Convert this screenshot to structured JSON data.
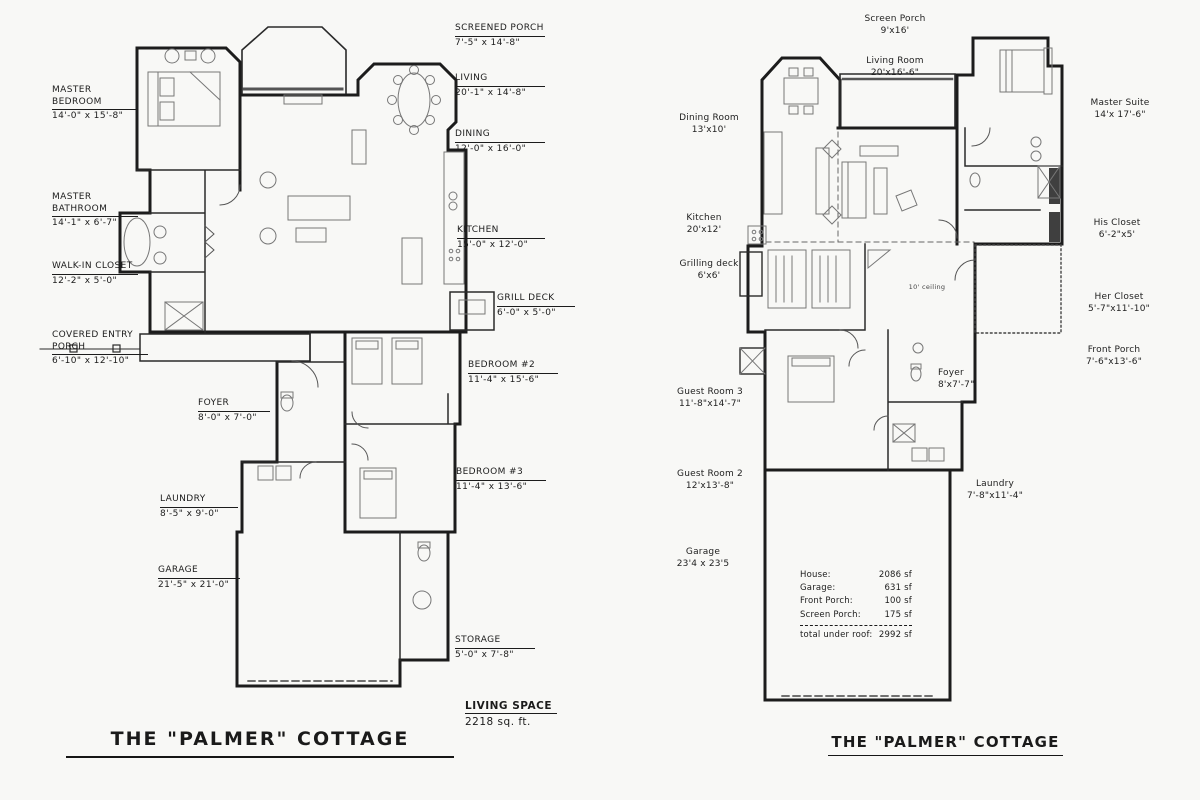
{
  "left_plan": {
    "title": "THE \"PALMER\" COTTAGE",
    "living_space": {
      "label": "LIVING SPACE",
      "value": "2218 sq. ft."
    },
    "labels": [
      {
        "name": "MASTER BEDROOM",
        "dims": "14'-0\" x 15'-8\""
      },
      {
        "name": "MASTER BATHROOM",
        "dims": "14'-1\" x 6'-7\""
      },
      {
        "name": "WALK-IN CLOSET",
        "dims": "12'-2\" x 5'-0\""
      },
      {
        "name": "COVERED ENTRY PORCH",
        "dims": "6'-10\" x 12'-10\""
      },
      {
        "name": "SCREENED PORCH",
        "dims": "7'-5\" x 14'-8\""
      },
      {
        "name": "LIVING",
        "dims": "20'-1\" x 14'-8\""
      },
      {
        "name": "DINING",
        "dims": "12'-0\" x 16'-0\""
      },
      {
        "name": "KITCHEN",
        "dims": "15'-0\" x 12'-0\""
      },
      {
        "name": "GRILL DECK",
        "dims": "6'-0\" x 5'-0\""
      },
      {
        "name": "BEDROOM #2",
        "dims": "11'-4\" x 15'-6\""
      },
      {
        "name": "BEDROOM #3",
        "dims": "11'-4\" x 13'-6\""
      },
      {
        "name": "FOYER",
        "dims": "8'-0\" x 7'-0\""
      },
      {
        "name": "LAUNDRY",
        "dims": "8'-5\" x 9'-0\""
      },
      {
        "name": "GARAGE",
        "dims": "21'-5\" x 21'-0\""
      },
      {
        "name": "STORAGE",
        "dims": "5'-0\" x 7'-8\""
      }
    ]
  },
  "right_plan": {
    "title": "THE \"PALMER\" COTTAGE",
    "ceiling_note": "10' ceiling",
    "labels": [
      {
        "name": "Screen Porch",
        "dims": "9'x16'"
      },
      {
        "name": "Living Room",
        "dims": "20'x16'-6\""
      },
      {
        "name": "Master Suite",
        "dims": "14'x 17'-6\""
      },
      {
        "name": "Dining Room",
        "dims": "13'x10'"
      },
      {
        "name": "Kitchen",
        "dims": "20'x12'"
      },
      {
        "name": "Grilling deck",
        "dims": "6'x6'"
      },
      {
        "name": "His Closet",
        "dims": "6'-2\"x5'"
      },
      {
        "name": "Her Closet",
        "dims": "5'-7\"x11'-10\""
      },
      {
        "name": "Front Porch",
        "dims": "7'-6\"x13'-6\""
      },
      {
        "name": "Foyer",
        "dims": "8'x7'-7\""
      },
      {
        "name": "Guest Room 3",
        "dims": "11'-8\"x14'-7\""
      },
      {
        "name": "Guest Room 2",
        "dims": "12'x13'-8\""
      },
      {
        "name": "Laundry",
        "dims": "7'-8\"x11'-4\""
      },
      {
        "name": "Garage",
        "dims": "23'4 x 23'5"
      }
    ],
    "area_table": {
      "rows": [
        {
          "label": "House:",
          "value": "2086 sf"
        },
        {
          "label": "Garage:",
          "value": "631 sf"
        },
        {
          "label": "Front Porch:",
          "value": "100 sf"
        },
        {
          "label": "Screen Porch:",
          "value": "175 sf"
        }
      ],
      "total": {
        "label": "total under roof:",
        "value": "2992 sf"
      }
    }
  }
}
